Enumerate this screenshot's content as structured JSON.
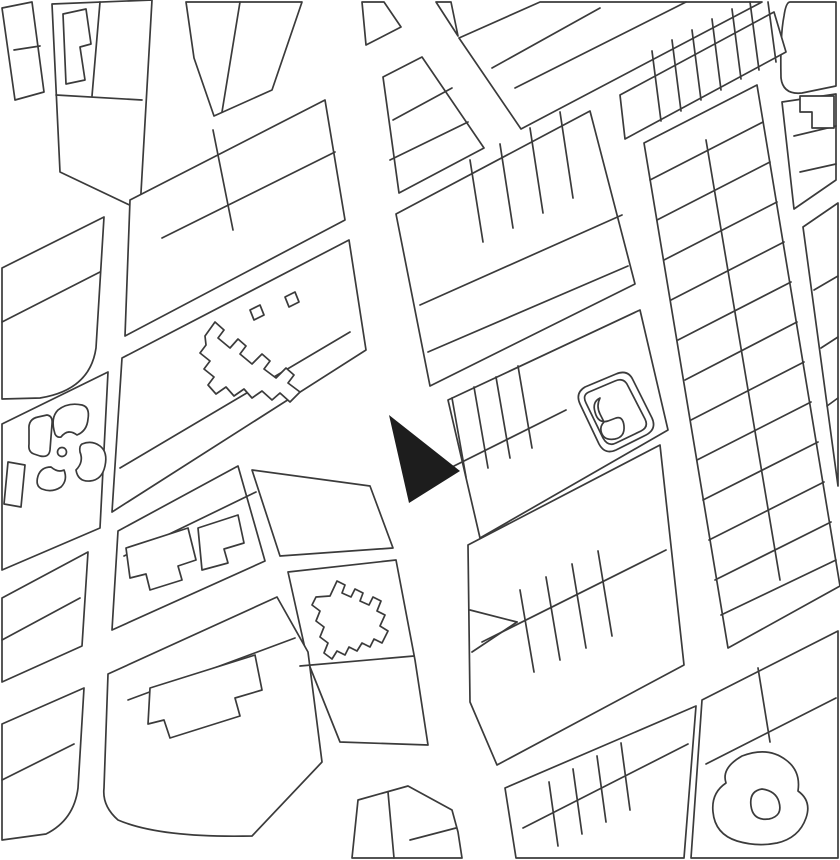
{
  "canvas": {
    "width": 840,
    "height": 860,
    "background": "#ffffff"
  },
  "style": {
    "line_color": "#3b3b3b",
    "line_width": 1.7,
    "block_fill": "#ffffff",
    "marker_fill": "#1d1d1d"
  },
  "marker": {
    "points": "389,415 460,471 409,503"
  },
  "blocks": [
    {
      "name": "block-nw-corner-strip",
      "pts": "2,8 32,2 44,92 15,100"
    },
    {
      "name": "block-nw-main",
      "pts": "52,4 152,0 140,210 60,172"
    },
    {
      "name": "block-nw-upper",
      "pts": "186,2 302,2 272,90 214,116 194,58"
    },
    {
      "name": "block-top-center-small",
      "pts": "362,2 384,2 401,27 366,45"
    },
    {
      "name": "block-top-center-trapezoid",
      "pts": "383,77 422,57 484,148 399,193"
    },
    {
      "name": "block-top-sliver",
      "pts": "436,2 451,2 458,36"
    },
    {
      "name": "block-top-right-triangle",
      "pts": "540,2 762,2 521,129 459,38"
    },
    {
      "name": "block-top-far-right-rounded",
      "d": "M790,2 L836,2 L836,86 L802,93 Q783,95 781,78 Q780,36 784,16 Q786,2 790,2 Z"
    },
    {
      "name": "block-topright-strips",
      "pts": "620,95 774,12 786,52 625,139"
    },
    {
      "name": "block-west-upper",
      "d": "M2,268 L104,217 L96,348 Q90,390 40,398 L2,399 Z"
    },
    {
      "name": "block-west-park",
      "pts": "2,424 108,372 100,528 2,570"
    },
    {
      "name": "block-west-mid",
      "pts": "2,598 88,552 82,646 2,682"
    },
    {
      "name": "block-west-lower",
      "d": "M2,724 L84,688 L78,788 Q74,820 46,834 L2,840 Z"
    },
    {
      "name": "block-centerleft-upper",
      "pts": "130,200 325,100 345,220 125,336"
    },
    {
      "name": "block-centerleft-terrace",
      "pts": "122,358 349,240 366,350 112,512"
    },
    {
      "name": "block-centerleft-lower",
      "pts": "118,531 238,466 265,561 112,630"
    },
    {
      "name": "block-wedge-apex",
      "pts": "252,470 370,486 393,548 280,556"
    },
    {
      "name": "block-crenellated",
      "pts": "288,572 396,560 415,660 428,745 340,742 308,662"
    },
    {
      "name": "block-sw-notched",
      "d": "M108,674 L277,597 L308,652 L322,762 L252,836 Q160,838 118,820 Q102,806 104,788 Z"
    },
    {
      "name": "block-center-east-upper",
      "pts": "396,214 590,111 635,284 430,386"
    },
    {
      "name": "block-pond",
      "pts": "448,400 640,310 668,430 480,538"
    },
    {
      "name": "block-center-east-lower",
      "pts": "468,545 660,445 684,665 497,765 470,702"
    },
    {
      "name": "block-east-band",
      "pts": "644,143 757,85 840,586 728,648"
    },
    {
      "name": "block-east-edge-upper",
      "pts": "782,102 836,94 836,180 794,209"
    },
    {
      "name": "block-east-edge-lower",
      "pts": "803,227 838,203 838,486"
    },
    {
      "name": "block-south-center",
      "pts": "505,788 696,706 684,858 516,858"
    },
    {
      "name": "block-south-east-garden",
      "pts": "702,700 838,631 838,858 691,858"
    },
    {
      "name": "block-south-small",
      "pts": "358,800 408,786 452,810 458,832 462,858 352,858"
    }
  ],
  "parcel_lines": [
    [
      14,
      50,
      40,
      46
    ],
    [
      56,
      95,
      142,
      100
    ],
    [
      100,
      2,
      92,
      96
    ],
    [
      240,
      2,
      222,
      112
    ],
    [
      393,
      120,
      452,
      88
    ],
    [
      390,
      160,
      468,
      122
    ],
    [
      515,
      88,
      686,
      2
    ],
    [
      492,
      68,
      600,
      8
    ],
    [
      652,
      51,
      661,
      121
    ],
    [
      672,
      40,
      681,
      111
    ],
    [
      692,
      30,
      701,
      100
    ],
    [
      712,
      19,
      721,
      90
    ],
    [
      732,
      9,
      741,
      79
    ],
    [
      750,
      2,
      759,
      70
    ],
    [
      768,
      2,
      776,
      62
    ],
    [
      213,
      130,
      233,
      230
    ],
    [
      162,
      238,
      335,
      152
    ],
    [
      120,
      468,
      350,
      332
    ],
    [
      124,
      556,
      256,
      492
    ],
    [
      128,
      700,
      295,
      638
    ],
    [
      2,
      322,
      100,
      272
    ],
    [
      2,
      640,
      80,
      598
    ],
    [
      2,
      780,
      74,
      744
    ],
    [
      470,
      160,
      483,
      242
    ],
    [
      500,
      144,
      513,
      228
    ],
    [
      530,
      128,
      543,
      213
    ],
    [
      560,
      112,
      573,
      198
    ],
    [
      420,
      305,
      622,
      215
    ],
    [
      428,
      352,
      628,
      266
    ],
    [
      452,
      398,
      466,
      477
    ],
    [
      474,
      387,
      488,
      468
    ],
    [
      496,
      377,
      510,
      458
    ],
    [
      518,
      366,
      532,
      448
    ],
    [
      442,
      472,
      566,
      410
    ],
    [
      520,
      590,
      534,
      672
    ],
    [
      546,
      577,
      560,
      660
    ],
    [
      572,
      564,
      586,
      648
    ],
    [
      598,
      551,
      612,
      636
    ],
    [
      482,
      642,
      666,
      550
    ],
    [
      470,
      610,
      517,
      622
    ],
    [
      472,
      652,
      517,
      622
    ],
    [
      650,
      180,
      763,
      122
    ],
    [
      657,
      220,
      770,
      162
    ],
    [
      664,
      260,
      777,
      202
    ],
    [
      671,
      300,
      784,
      242
    ],
    [
      678,
      340,
      791,
      282
    ],
    [
      685,
      380,
      797,
      322
    ],
    [
      691,
      420,
      804,
      362
    ],
    [
      697,
      460,
      811,
      402
    ],
    [
      703,
      500,
      818,
      442
    ],
    [
      709,
      540,
      824,
      482
    ],
    [
      715,
      580,
      831,
      522
    ],
    [
      721,
      615,
      836,
      560
    ],
    [
      706,
      140,
      780,
      580
    ],
    [
      794,
      136,
      836,
      126
    ],
    [
      800,
      172,
      836,
      164
    ],
    [
      814,
      290,
      838,
      276
    ],
    [
      821,
      348,
      838,
      337
    ],
    [
      827,
      406,
      838,
      398
    ],
    [
      523,
      828,
      688,
      744
    ],
    [
      549,
      782,
      558,
      846
    ],
    [
      573,
      769,
      582,
      834
    ],
    [
      597,
      756,
      606,
      822
    ],
    [
      621,
      743,
      630,
      810
    ],
    [
      706,
      764,
      836,
      698
    ],
    [
      758,
      668,
      770,
      742
    ],
    [
      388,
      792,
      394,
      858
    ],
    [
      410,
      840,
      456,
      828
    ],
    [
      300,
      666,
      414,
      656
    ]
  ],
  "features": [
    {
      "name": "building-footprint-nw",
      "type": "polygon",
      "pts": "63,14 86,9 91,44 80,47 85,80 66,84"
    },
    {
      "name": "building-row-jagged",
      "type": "path",
      "d": "M205,336 L215,322 L224,330 L218,338 L230,348 L238,339 L246,346 L240,354 L252,364 L262,354 L270,361 L264,369 L276,378 L286,368 L294,375 L288,383 L300,392 L290,402 L280,393 L272,400 L262,391 L252,398 L244,389 L234,396 L226,387 L216,394 L208,385 L214,377 L204,369 L210,361 L200,353 L206,345 Z"
    },
    {
      "name": "building-tooth-1",
      "type": "polygon",
      "pts": "250,310 260,305 264,315 254,320"
    },
    {
      "name": "building-tooth-2",
      "type": "polygon",
      "pts": "285,297 295,292 299,302 289,307"
    },
    {
      "name": "building-footprint-b1",
      "type": "polygon",
      "pts": "126,548 188,528 196,560 178,566 182,580 150,590 146,574 130,578"
    },
    {
      "name": "building-footprint-b2",
      "type": "polygon",
      "pts": "198,528 238,515 244,543 224,549 228,563 202,570"
    },
    {
      "name": "building-footprint-sw",
      "type": "polygon",
      "pts": "150,688 255,655 262,690 235,698 240,716 170,738 164,720 148,724"
    },
    {
      "name": "building-crenellated",
      "type": "path",
      "d": "M330,596 L337,581 L345,585 L342,593 L351,597 L355,589 L363,593 L360,601 L369,605 L373,597 L381,601 L377,611 L385,615 L380,626 L388,631 L382,643 L374,639 L370,647 L362,643 L357,651 L349,647 L345,655 L337,651 L332,659 L324,653 L328,643 L320,637 L324,627 L316,621 L320,611 L312,605 L316,597 Z"
    },
    {
      "name": "building-flag",
      "type": "polygon",
      "pts": "800,96 834,96 834,128 812,128 812,112 800,112"
    },
    {
      "name": "park-strip-parcel",
      "type": "polygon",
      "pts": "8,462 25,465 21,507 4,504"
    },
    {
      "name": "park-bed-nw",
      "type": "path",
      "d": "M29,430 Q28,419 38,417 L47,415 Q53,416 52,424 L50,450 Q49,458 40,456 L34,454 Q28,452 29,444 Z"
    },
    {
      "name": "park-bed-ne",
      "type": "path",
      "d": "M55,434 Q50,418 58,410 Q68,402 82,405 Q90,407 88,419 Q87,431 77,435 Q68,428 61,437 Q57,438 55,434 Z"
    },
    {
      "name": "park-bed-se",
      "type": "path",
      "d": "M82,444 Q92,440 100,446 Q108,452 105,466 Q102,480 90,481 Q78,482 76,470 Q84,462 80,452 Q79,446 82,444 Z"
    },
    {
      "name": "park-bed-sw",
      "type": "path",
      "d": "M64,470 Q68,480 61,487 Q52,493 42,489 Q35,486 38,476 Q41,467 51,467 Q58,473 64,470 Z"
    },
    {
      "name": "park-center-circle",
      "type": "circle",
      "cx": 62,
      "cy": 452,
      "r": 4.5
    },
    {
      "name": "pond-outline",
      "type": "path",
      "d": "M585,387 L616,374 Q628,369 633,380 L652,418 Q657,429 646,435 L616,450 Q605,455 599,444 L580,404 Q575,393 585,387 Z"
    },
    {
      "name": "pond-inner-ring",
      "type": "path",
      "d": "M589,392 L615,381 Q624,377 628,386 L645,419 Q649,427 641,431 L616,443 Q608,447 603,438 L586,403 Q582,395 589,392 Z"
    },
    {
      "name": "pond-island",
      "type": "path",
      "d": "M600,398 Q592,402 595,412 Q598,424 608,421 L616,418 Q623,416 624,426 Q625,437 615,439 Q603,441 601,431 Q600,426 604,422 L600,414 Q596,406 600,398 Z"
    },
    {
      "name": "garden-blob-outer",
      "type": "path",
      "d": "M742,756 Q768,746 786,760 Q801,771 798,791 Q812,801 806,818 Q799,838 777,843 Q757,847 737,841 Q715,834 713,812 Q711,793 726,783 Q721,768 742,756 Z"
    },
    {
      "name": "garden-blob-inner",
      "type": "path",
      "d": "M762,789 Q749,791 751,806 Q753,821 769,819 Q783,816 779,802 Q776,791 762,789 Z"
    }
  ]
}
